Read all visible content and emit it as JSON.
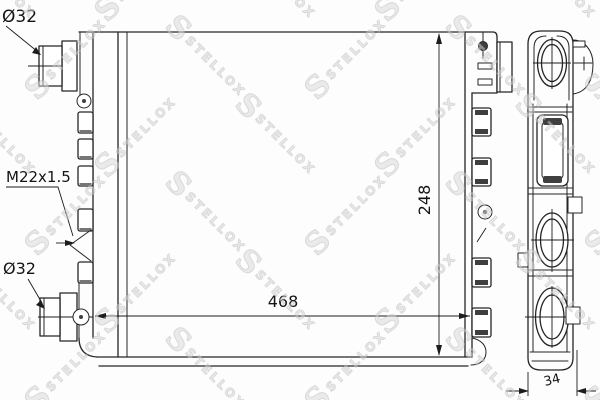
{
  "drawing": {
    "title": "radiator-technical-drawing",
    "labels": {
      "inlet_diameter": "Ø32",
      "drain_thread": "M22x1.5",
      "outlet_diameter": "Ø32"
    },
    "dimensions": {
      "width": "468",
      "height": "248",
      "depth": "34"
    },
    "watermark": {
      "logo": "S",
      "text": "STELLOX"
    },
    "colors": {
      "line": "#252525",
      "background": "#fdfdfd",
      "watermark": "#bcbcbc"
    }
  }
}
